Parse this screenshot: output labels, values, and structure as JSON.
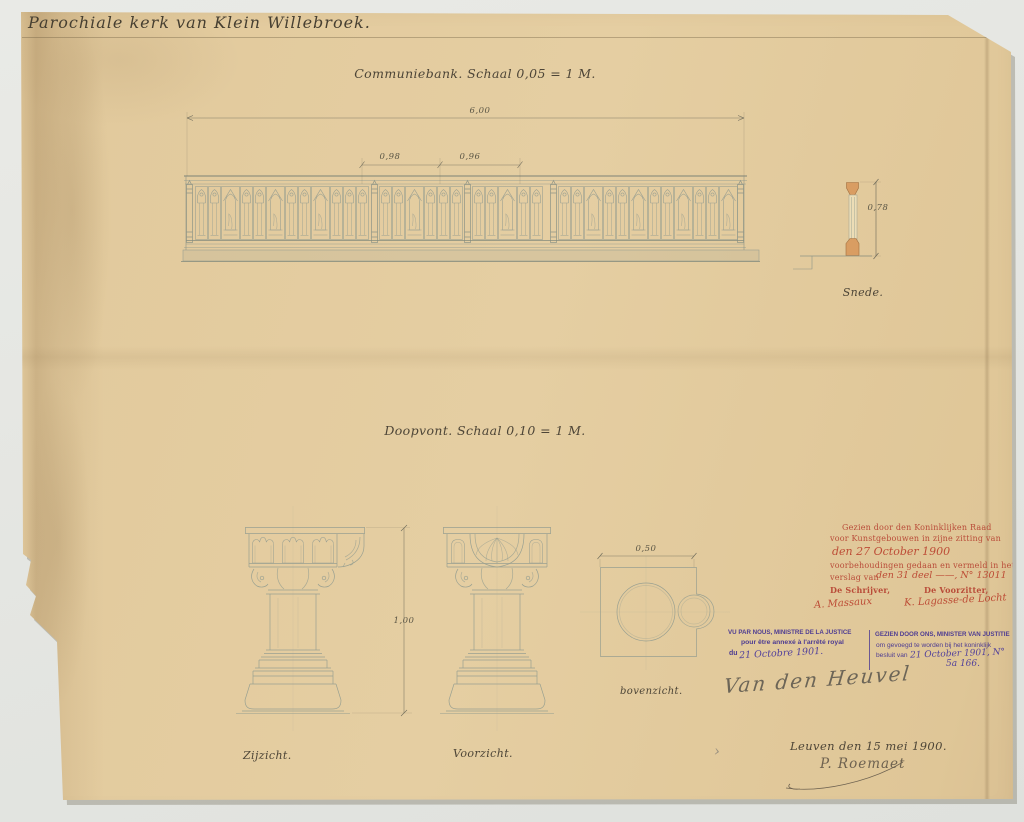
{
  "page": {
    "title": "Parochiale kerk van Klein Willebroek."
  },
  "colors": {
    "paper": "#e2ca9d",
    "ink": "#4d4537",
    "pencil": "#9aa092",
    "stamp_red": "#b94c39",
    "stamp_purple": "#4e3c92",
    "wood_section": "#d99d62"
  },
  "communiebank": {
    "caption": "Communiebank. Schaal 0,05 = 1 M.",
    "dim_total": "6,00",
    "dim_bay_left": "0,98",
    "dim_bay_right": "0,96",
    "section_label": "Snede.",
    "section_dim": "0,78"
  },
  "doopvont": {
    "caption": "Doopvont. Schaal 0,10 = 1 M.",
    "dim_height": "1,00",
    "dim_plan": "0,50",
    "label_side": "Zijzicht.",
    "label_front": "Voorzicht.",
    "label_top": "bovenzicht."
  },
  "stamps": {
    "red": {
      "lines": [
        "Gezien door den Koninklijken Raad",
        "voor Kunstgebouwen in zijne zitting van",
        "den 27 October 1900",
        "voorbehoudingen gedaan en vermeld in het",
        "verslag van",
        "den 31 deel ——, N° 13011"
      ],
      "clerk_title": "De Schrijver,",
      "chair_title": "De Voorzitter,",
      "clerk_signature": "A. Massaux",
      "chair_signature": "K. Lagasse-de Locht"
    },
    "purple_fr": {
      "lines": [
        "VU PAR NOUS, MINISTRE DE LA JUSTICE",
        "pour être annexé à l'arrêté royal"
      ],
      "prefix": "du",
      "date": "21 Octobre 1901."
    },
    "purple_nl": {
      "lines": [
        "GEZIEN DOOR ONS, MINISTER VAN JUSTITIE",
        "om gevoegd te worden bij het koninklijk"
      ],
      "prefix": "besluit van",
      "date": "21 October 1901, N°",
      "number": "5a 166."
    },
    "minister_signature": "Van den Heuvel"
  },
  "colophon": {
    "place_date": "Leuven den 15 mei 1900.",
    "signature": "P. Roemaet",
    "mark": "›"
  }
}
